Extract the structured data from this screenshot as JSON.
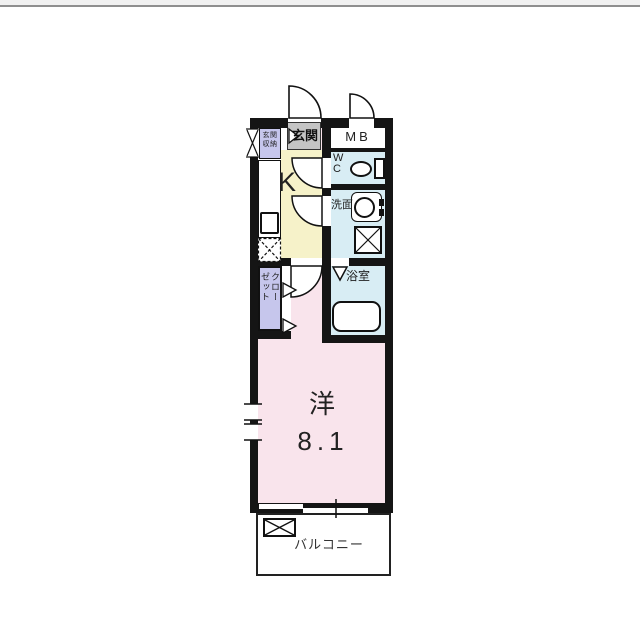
{
  "page": {
    "top_bar_color": "#f1f1f1",
    "top_line_color": "#8f8f8f",
    "background": "#ffffff"
  },
  "rooms": {
    "entrance_storage": {
      "label": "玄関収納",
      "line1": "玄関",
      "line2": "収納"
    },
    "entrance": {
      "label": "玄関"
    },
    "meter_box": {
      "label": "MB"
    },
    "kitchen": {
      "label": "K"
    },
    "toilet": {
      "label": "WC",
      "line1": "W",
      "line2": "C"
    },
    "washroom": {
      "label": "洗面"
    },
    "bathroom": {
      "label": "浴室"
    },
    "closet": {
      "label": "クローゼット",
      "column1": "クロー",
      "column2": "ゼット"
    },
    "western_room": {
      "label": "洋",
      "size": "8.1"
    },
    "balcony": {
      "label": "バルコニー"
    }
  },
  "colors": {
    "wall": "#151515",
    "kitchen": "#f6f2c9",
    "western_room": "#f9e4ec",
    "wet_area": "#d8edf4",
    "closet": "#c6c6ec",
    "entrance": "#c4c4c4",
    "meter_box": "#ffffff",
    "balcony": "#ffffff"
  }
}
